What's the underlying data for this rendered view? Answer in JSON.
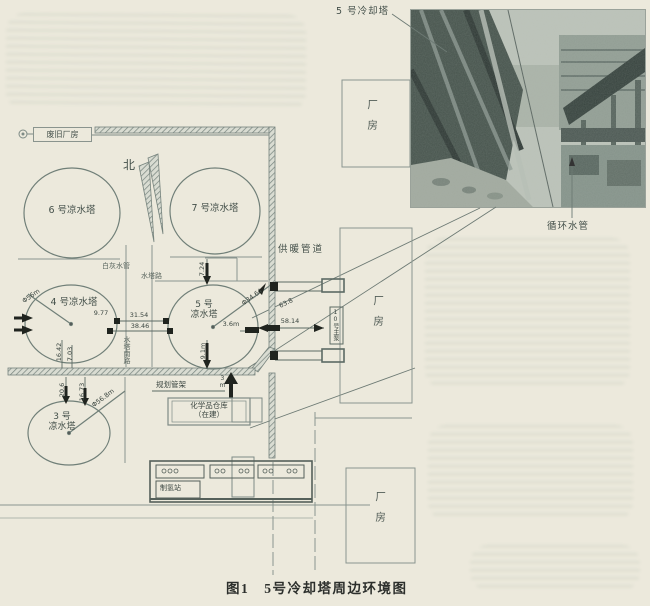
{
  "page": {
    "caption": "图1　5号冷却塔周边环境图",
    "colors": {
      "paper": "#ece9dc",
      "line": "#7e8b86",
      "ink": "#20241f",
      "hatch": "#76837d"
    }
  },
  "photo": {
    "tower_label": "5 号冷却塔",
    "pipe_label": "循环水管"
  },
  "plan": {
    "north": "北",
    "old_factory": "废旧厂房",
    "supply_pipe": "供暖管道",
    "lime_pipe": "白灰水管",
    "road_shuita": "水塔路",
    "road_shuita_south": "水塔南路",
    "factory": "厂房",
    "pump_house": "10号主泵",
    "chem_line1": "化学品仓库",
    "chem_line2": "（在建）",
    "rack_label": "规划管架",
    "rack_width": "3m",
    "hydrogen": "制氢站",
    "towers": {
      "t6": "6 号凉水塔",
      "t7": "7 号凉水塔",
      "t4": "4 号凉水塔",
      "t5a": "5 号",
      "t5b": "凉水塔",
      "t3a": "3 号",
      "t3b": "凉水塔"
    },
    "dims": {
      "d724": "7.24",
      "d977": "9.77",
      "d3154": "31.54",
      "d3846": "38.46",
      "d1642": "16.42",
      "d703": "7.03",
      "d206": "20.6",
      "d1673": "16.73",
      "d91": "9.1m",
      "d36": "3.6m",
      "d3464": "Φ34.64",
      "d638": "63.8",
      "d5814": "58.14",
      "dt4": "Φ56m",
      "dt3": "Φ56.8m"
    }
  }
}
